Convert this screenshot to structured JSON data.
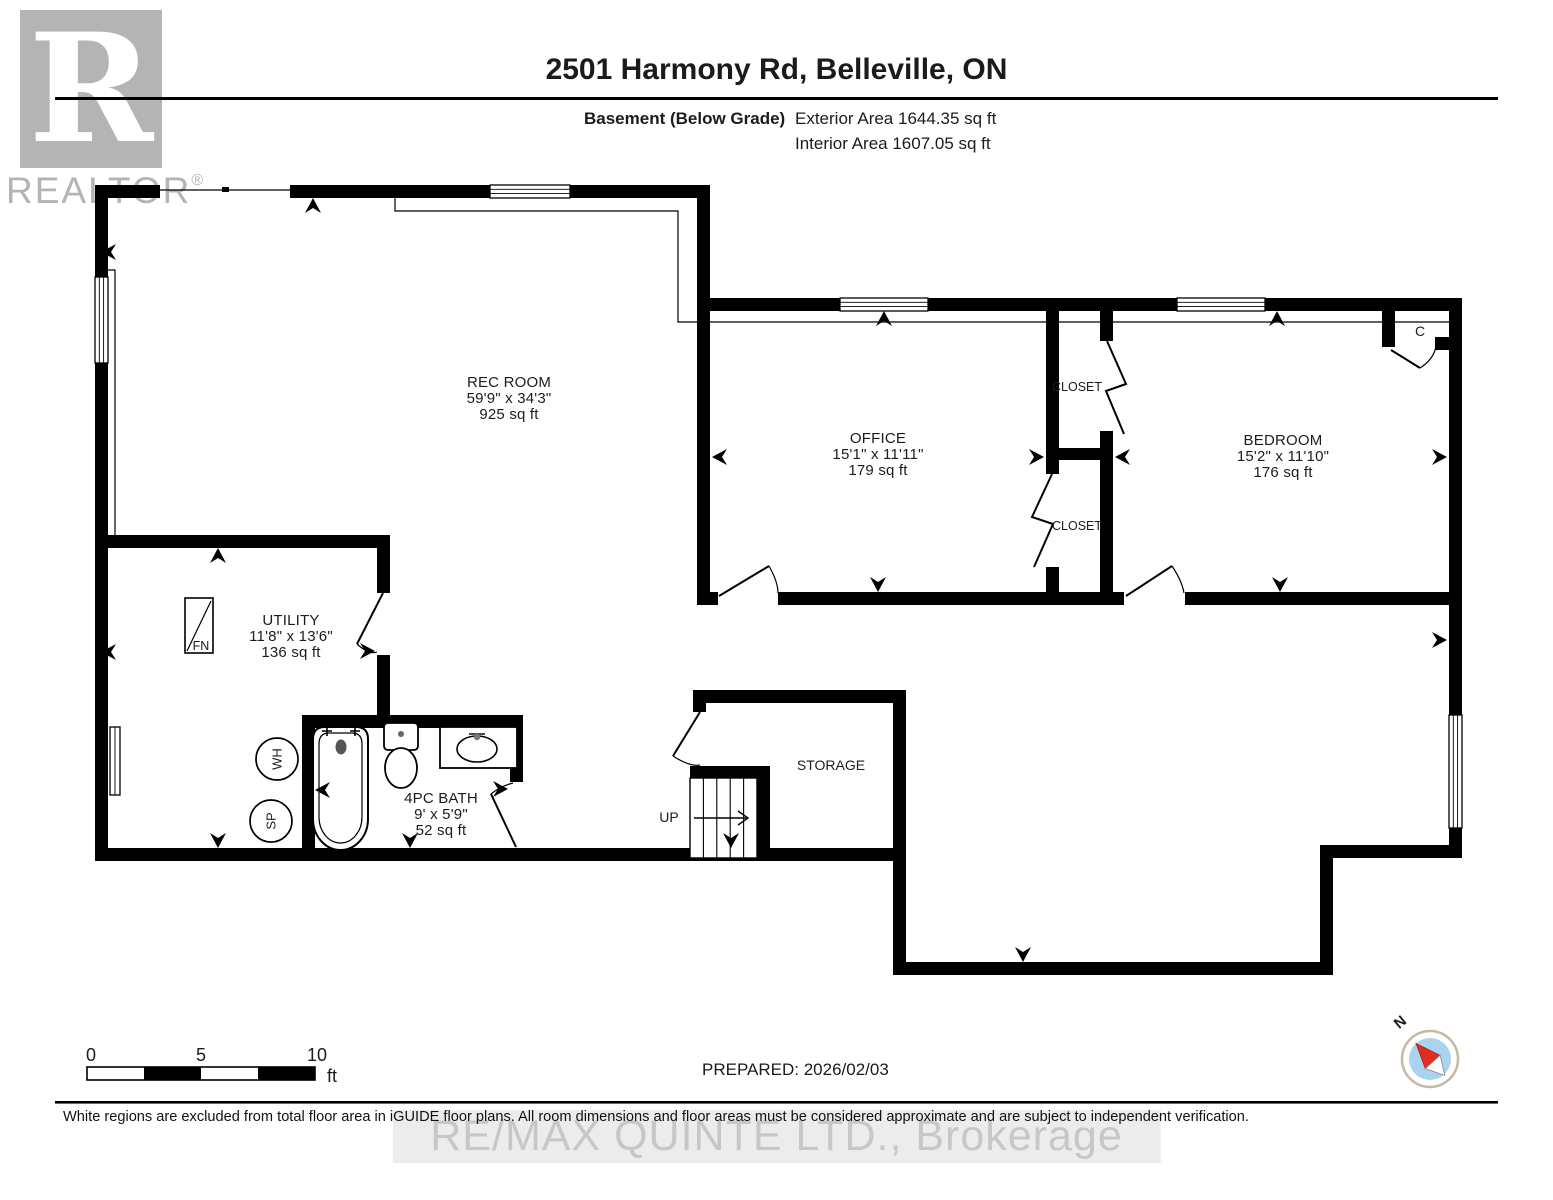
{
  "header": {
    "title": "2501 Harmony Rd, Belleville, ON",
    "floor_label": "Basement (Below Grade)",
    "exterior_area": "Exterior Area 1644.35 sq ft",
    "interior_area": "Interior Area 1607.05 sq ft"
  },
  "rooms": [
    {
      "name": "REC ROOM",
      "dims": "59'9\" x 34'3\"",
      "area": "925 sq ft"
    },
    {
      "name": "OFFICE",
      "dims": "15'1\" x 11'11\"",
      "area": "179 sq ft"
    },
    {
      "name": "BEDROOM",
      "dims": "15'2\" x 11'10\"",
      "area": "176 sq ft"
    },
    {
      "name": "UTILITY",
      "dims": "11'8\" x 13'6\"",
      "area": "136 sq ft"
    },
    {
      "name": "4PC BATH",
      "dims": "9' x 5'9\"",
      "area": "52 sq ft"
    },
    {
      "name": "STORAGE"
    }
  ],
  "labels": {
    "closet_upper": "CLOSET",
    "closet_lower": "CLOSET",
    "closet_small": "C",
    "up": "UP",
    "water_heater": "WH",
    "sump_pump": "SP",
    "furnace": "FN"
  },
  "scale_bar": {
    "tick0": "0",
    "tick5": "5",
    "tick10": "10",
    "unit": "ft"
  },
  "footer": {
    "prepared": "PREPARED: 2026/02/03",
    "disclaimer": "White regions are excluded from total floor area in iGUIDE floor plans. All room dimensions and floor areas must be considered approximate and are subject to independent verification."
  },
  "watermarks": {
    "logo_r": "R",
    "logo_text": "REALTOR",
    "logo_reg": "®",
    "brokerage": "RE/MAX QUINTE LTD., Brokerage"
  },
  "compass": {
    "north": "N"
  },
  "colors": {
    "wall": "#000000",
    "compass_blue": "#a9d3ee",
    "compass_red": "#e02c22",
    "compass_ring": "#c6b9a4",
    "watermark_gray": "#c7c7c7",
    "logo_gray": "#b4b4b4"
  }
}
